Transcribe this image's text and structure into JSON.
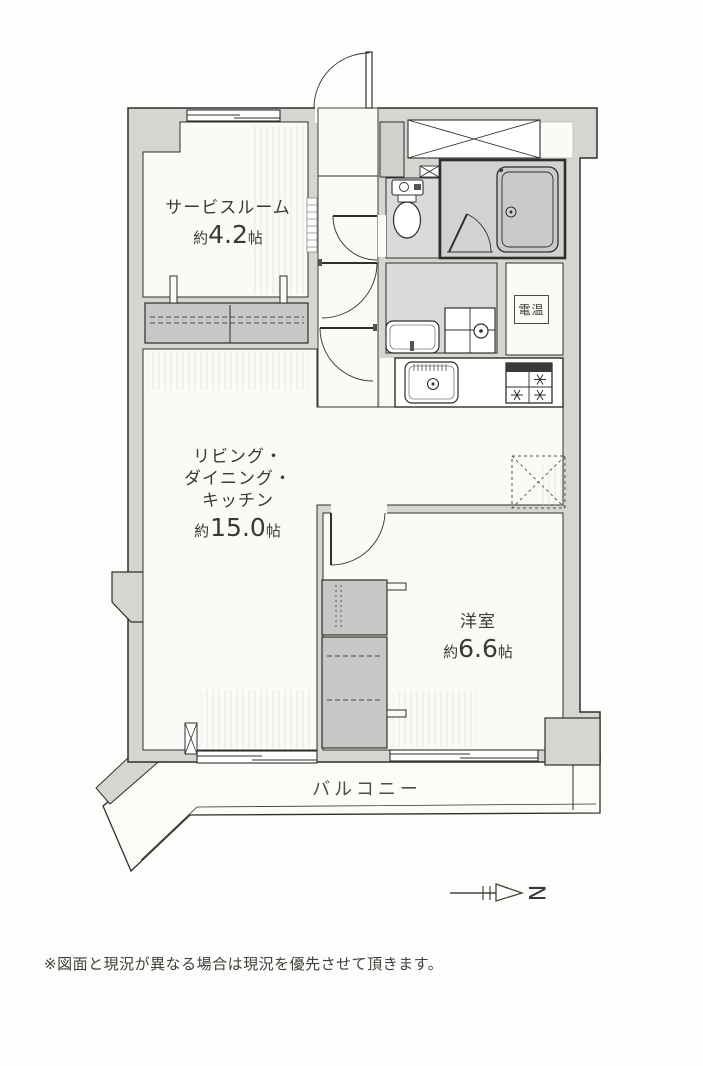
{
  "page": {
    "footnote": "※図面と現況が異なる場合は現況を優先させて頂きます。"
  },
  "floor_plan": {
    "rooms": {
      "service_room": {
        "name": "サービスルーム",
        "size_prefix": "約",
        "size_value": "4.2",
        "size_unit": "帖"
      },
      "ldk": {
        "line1": "リビング・",
        "line2": "ダイニング・",
        "line3": "キッチン",
        "size_prefix": "約",
        "size_value": "15.0",
        "size_unit": "帖"
      },
      "western_room": {
        "name": "洋室",
        "size_prefix": "約",
        "size_value": "6.6",
        "size_unit": "帖"
      },
      "balcony": {
        "name": "バルコニー"
      }
    },
    "labels": {
      "water_heater": "電温"
    },
    "compass": {
      "letter": "N"
    },
    "colors": {
      "wall_fill": "#d6d5d2",
      "line": "#2f2e2c",
      "floor": "#fbfaf7",
      "wet_area_floor": "#dadbd8",
      "bath_floor": "#d2d3d0",
      "closet_fill": "#c6c8c5"
    }
  }
}
